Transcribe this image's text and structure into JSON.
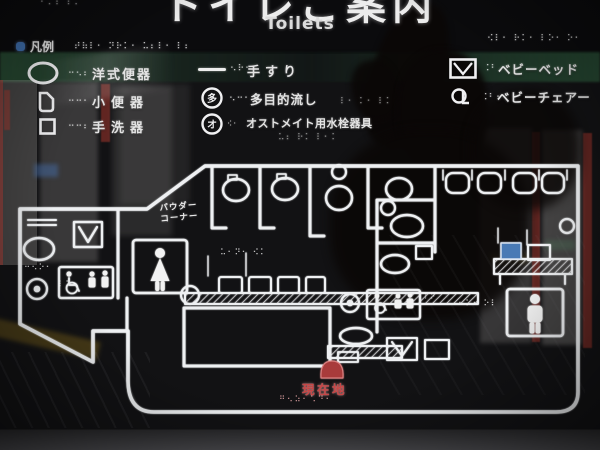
{
  "title": {
    "ja": "トイレご案内",
    "en": "Toilets"
  },
  "legend": {
    "header": "凡例",
    "header_braille": "⠞⠷⠇⠂ ⠝⠗⠅⠂  ⠥⠆⠇⠂ ⠇⠆",
    "top_braille_fragment": "⠂⠄⠆   ⠆⠄",
    "top_right_braille": "⠪⠇⠂ ⠗⠅⠂  ⠇⠕⠂ ⠕⠂",
    "items": [
      {
        "label": "洋式便器",
        "braille": "⠒⠢⠆"
      },
      {
        "label": "小便器",
        "braille": "⠒⠒⠂"
      },
      {
        "label": "手洗器",
        "braille": "⠒⠒⠆"
      },
      {
        "label": "手すり",
        "braille": "⠢⠗⠂"
      },
      {
        "label": "多目的流し",
        "braille": "⠢⠒⠂",
        "icon_char": "多",
        "braille_after": "⠇⠂ ⠅⠂ ⠇⠅"
      },
      {
        "label": "オストメイト用水栓器具",
        "braille": "⠪⠂",
        "icon_char": "オ",
        "braille_after": "⠥⠆ ⠗⠅ ⠇⠂⠅"
      },
      {
        "label": "ベビーベッド",
        "braille": "⠨⠃"
      },
      {
        "label": "ベビーチェアー",
        "braille": "⠨⠃⠂"
      }
    ]
  },
  "map": {
    "powder_corner": [
      "パウダー",
      "コーナー"
    ],
    "you_are_here": "現在地",
    "braille": {
      "you_are_here": "⠛⠢⠵⠂⠡⠙⠂",
      "left_oval": "⠒⠢⠕⠂",
      "left_room": "⠇⠅⠂",
      "stall_doors": "⠥⠂⠝⠂ ⠪⠅",
      "mens": "⠂⠅⠂ ⠕⠇",
      "mens_side": "⠇⠕"
    }
  },
  "colors": {
    "line": "#f0f0f2",
    "marker_red": "#c64545",
    "screen_blue": "#4a7ab5",
    "band_green": "#2e5c40",
    "legend_dot_blue": "#3f6fae"
  }
}
